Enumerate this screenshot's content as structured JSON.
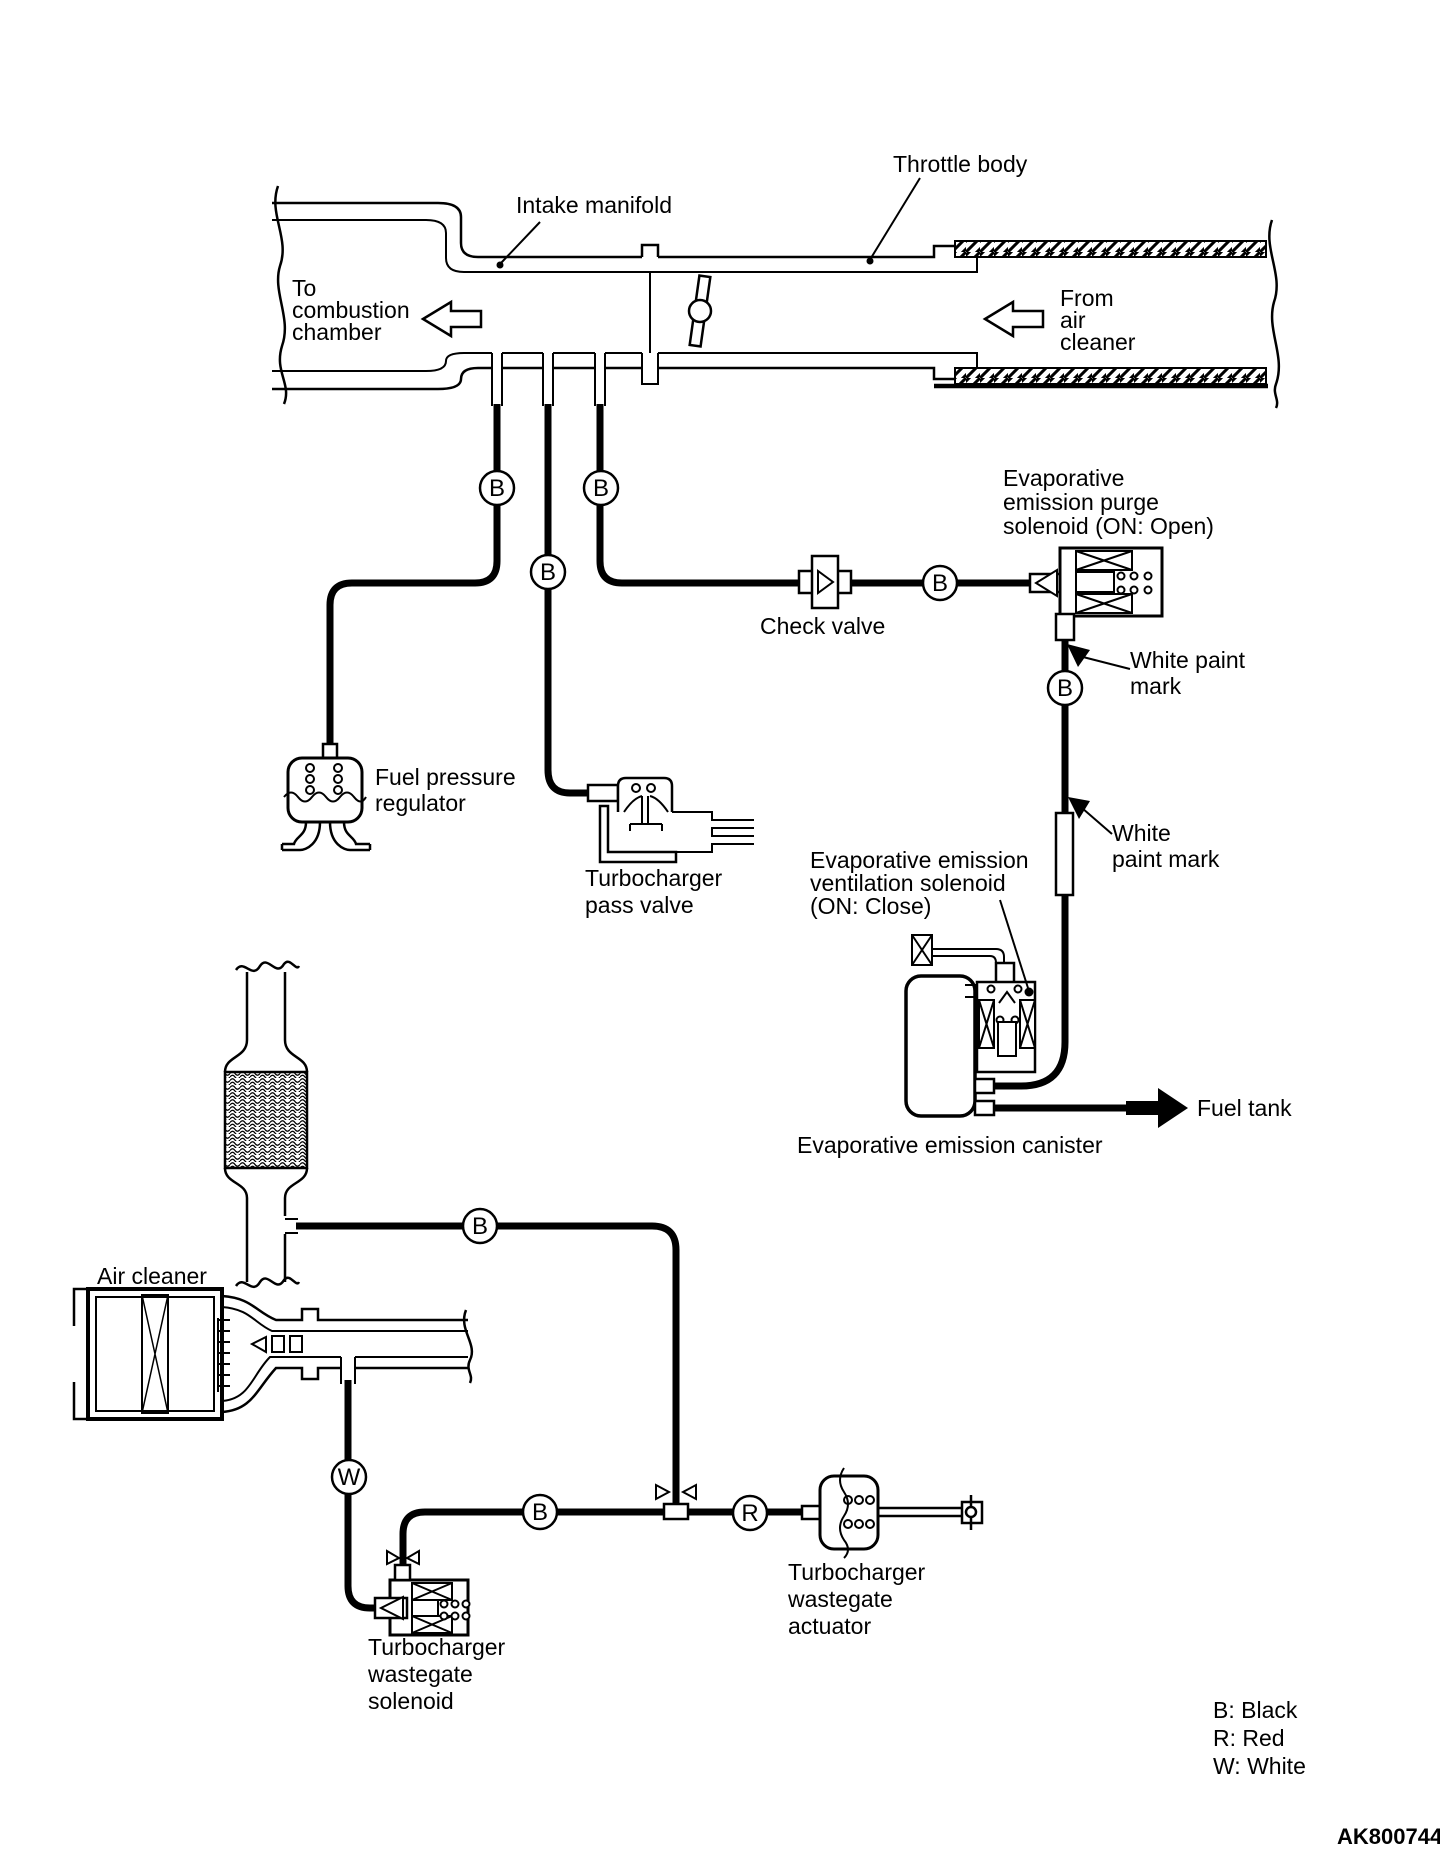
{
  "figure": {
    "code": "AK800744",
    "background": "#ffffff",
    "line_color": "#000000"
  },
  "pipe": {
    "intake_manifold": "Intake manifold",
    "throttle_body": "Throttle body",
    "to_combustion_chamber": [
      "To",
      "combustion",
      "chamber"
    ],
    "from_air_cleaner": [
      "From",
      "air",
      "cleaner"
    ]
  },
  "components": {
    "purge_solenoid": [
      "Evaporative",
      "emission purge",
      "solenoid (ON: Open)"
    ],
    "check_valve": "Check valve",
    "white_paint_mark_upper": [
      "White paint",
      "mark"
    ],
    "white_paint_mark_lower": [
      "White",
      "paint mark"
    ],
    "fuel_pressure_regulator": [
      "Fuel pressure",
      "regulator"
    ],
    "turbocharger_pass_valve": [
      "Turbocharger",
      "pass valve"
    ],
    "ventilation_solenoid": [
      "Evaporative emission",
      "ventilation solenoid",
      "(ON: Close)"
    ],
    "canister": "Evaporative emission canister",
    "fuel_tank": "Fuel tank",
    "air_cleaner": "Air cleaner",
    "wastegate_solenoid": [
      "Turbocharger",
      "wastegate",
      "solenoid"
    ],
    "wastegate_actuator": [
      "Turbocharger",
      "wastegate",
      "actuator"
    ]
  },
  "hose_markers": {
    "black": "B",
    "red": "R",
    "white": "W"
  },
  "legend": [
    "B: Black",
    "R: Red",
    "W: White"
  ]
}
